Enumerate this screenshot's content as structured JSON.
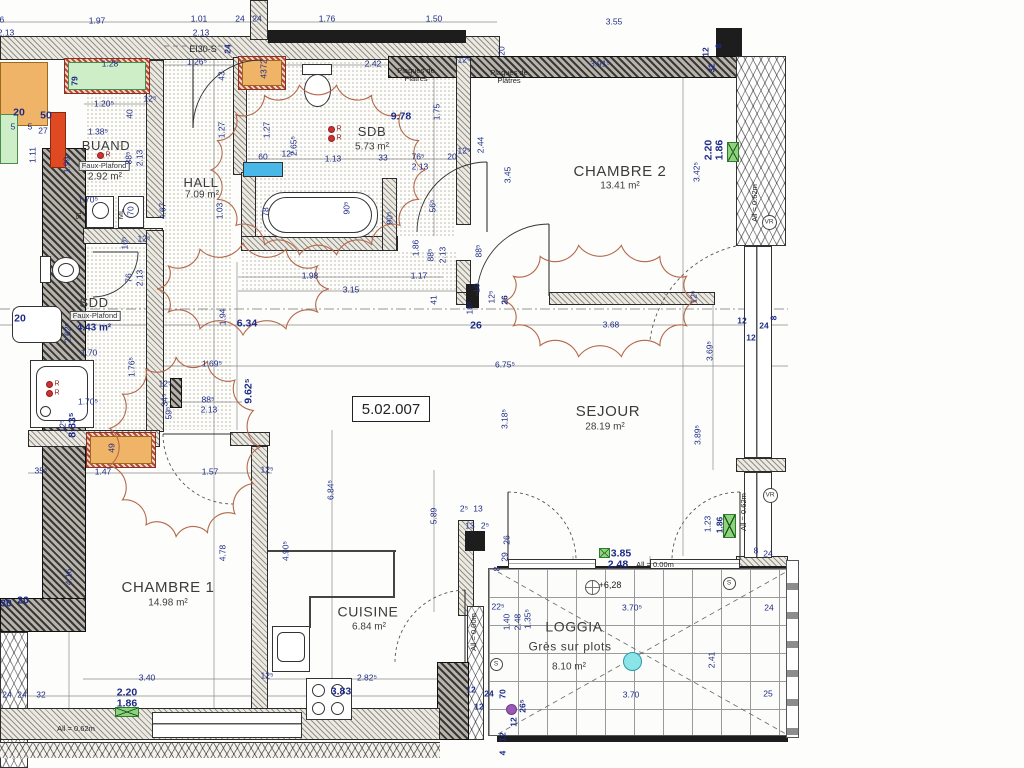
{
  "ref": "5.02.007",
  "r_label": "R",
  "colors": {
    "dim_blue": "#1d2b86",
    "cloud": "#b4684a",
    "wall_dark": "#1d1d1d",
    "green_marker": "#8fd27e",
    "cyan_fixture": "#49b8e8",
    "orange_fill": "#f0b469",
    "red_fill": "#e04a22",
    "purple_dot": "#9b59b6",
    "cyan_dot": "#8ae4e8"
  },
  "rooms": [
    {
      "name": "BUAND",
      "ns": 13,
      "x": 106,
      "y": 146,
      "note": "Faux-Plafond",
      "boxed": true,
      "nx": 104,
      "ny": 166,
      "area": "2.92 m²",
      "afs": 10,
      "ax": 105,
      "ay": 178
    },
    {
      "name": "HALL",
      "ns": 13,
      "x": 201,
      "y": 183,
      "area": "7.09 m²",
      "afs": 10,
      "ax": 202,
      "ay": 196
    },
    {
      "name": "SDB",
      "ns": 13,
      "x": 372,
      "y": 132,
      "area": "5.73 m²",
      "afs": 10,
      "ax": 372,
      "ay": 148
    },
    {
      "name": "CHAMBRE 2",
      "ns": 15,
      "x": 620,
      "y": 172,
      "area": "13.41 m²",
      "afs": 10,
      "ax": 620,
      "ay": 187
    },
    {
      "name": "SDD",
      "ns": 13,
      "x": 94,
      "y": 303,
      "note": "Faux-Plafond",
      "boxed": true,
      "nx": 95,
      "ny": 316,
      "area": "4.43 m²",
      "afs": 10,
      "ax": 94,
      "ay": 329,
      "area_blue": true
    },
    {
      "name": "SEJOUR",
      "ns": 15,
      "x": 608,
      "y": 412,
      "area": "28.19 m²",
      "afs": 10,
      "ax": 605,
      "ay": 428
    },
    {
      "name": "CHAMBRE 1",
      "ns": 15,
      "x": 168,
      "y": 588,
      "area": "14.98 m²",
      "afs": 10,
      "ax": 168,
      "ay": 604
    },
    {
      "name": "CUISINE",
      "ns": 14,
      "x": 368,
      "y": 612,
      "area": "6.84 m²",
      "afs": 10,
      "ax": 369,
      "ay": 628
    },
    {
      "name": "LOGGIA",
      "ns": 14,
      "x": 574,
      "y": 627,
      "note": "Grès sur plots",
      "boxed": false,
      "nfs": 12,
      "nx": 570,
      "ny": 647,
      "area": "8.10 m²",
      "afs": 10,
      "ax": 569,
      "ay": 668
    }
  ],
  "labels": [
    {
      "t": "1.76",
      "x": -4,
      "y": 20,
      "r": 0,
      "c": "d"
    },
    {
      "t": "2.13",
      "x": 6,
      "y": 33,
      "r": 0,
      "c": "d"
    },
    {
      "t": "1.97",
      "x": 97,
      "y": 21,
      "r": 0,
      "c": "d"
    },
    {
      "t": "1.01",
      "x": 199,
      "y": 19,
      "r": 0,
      "c": "d"
    },
    {
      "t": "2.13",
      "x": 201,
      "y": 33,
      "r": 0,
      "c": "d"
    },
    {
      "t": "24",
      "x": 240,
      "y": 19,
      "r": 0,
      "c": "d"
    },
    {
      "t": "24",
      "x": 257,
      "y": 19,
      "r": 0,
      "c": "d"
    },
    {
      "t": "1.76",
      "x": 327,
      "y": 19,
      "r": 0,
      "c": "d"
    },
    {
      "t": "1.50",
      "x": 434,
      "y": 19,
      "r": 0,
      "c": "d"
    },
    {
      "t": "3.55",
      "x": 614,
      "y": 22,
      "r": 0,
      "c": "d"
    },
    {
      "t": "EI30-S",
      "x": 203,
      "y": 50,
      "r": 0,
      "c": "k2"
    },
    {
      "t": "24",
      "x": 228,
      "y": 49,
      "r": 1,
      "c": "b2"
    },
    {
      "t": "20",
      "x": 502,
      "y": 51,
      "r": 1,
      "c": "d"
    },
    {
      "t": "1.26⁵",
      "x": 197,
      "y": 62,
      "r": 0,
      "c": "d"
    },
    {
      "t": "43",
      "x": 222,
      "y": 76,
      "r": 1,
      "c": "d"
    },
    {
      "t": "1.28",
      "x": 110,
      "y": 64,
      "r": 0,
      "c": "d"
    },
    {
      "t": "79",
      "x": 75,
      "y": 81,
      "r": 1,
      "c": "b2"
    },
    {
      "t": "72",
      "x": 264,
      "y": 64,
      "r": 1,
      "c": "d"
    },
    {
      "t": "43",
      "x": 264,
      "y": 74,
      "r": 1,
      "c": "d"
    },
    {
      "t": "2.42",
      "x": 373,
      "y": 64,
      "r": 0,
      "c": "d"
    },
    {
      "t": "Plaques de\nPlâtres",
      "x": 416,
      "y": 75,
      "r": 0,
      "c": "k"
    },
    {
      "t": "Plaques de\nPlâtres",
      "x": 509,
      "y": 77,
      "r": 0,
      "c": "k"
    },
    {
      "t": "12⁵",
      "x": 464,
      "y": 60,
      "r": 0,
      "c": "d"
    },
    {
      "t": "3.91⁵",
      "x": 600,
      "y": 64,
      "r": 0,
      "c": "d"
    },
    {
      "t": "12",
      "x": 706,
      "y": 52,
      "r": 1,
      "c": "b2"
    },
    {
      "t": "8",
      "x": 719,
      "y": 46,
      "r": 1,
      "c": "b2"
    },
    {
      "t": "32",
      "x": 712,
      "y": 68,
      "r": 1,
      "c": "b2"
    },
    {
      "t": "1.20⁵",
      "x": 104,
      "y": 104,
      "r": 0,
      "c": "d"
    },
    {
      "t": "12⁵",
      "x": 150,
      "y": 99,
      "r": 0,
      "c": "d"
    },
    {
      "t": "40",
      "x": 130,
      "y": 114,
      "r": 1,
      "c": "d"
    },
    {
      "t": "1.38⁵",
      "x": 98,
      "y": 132,
      "r": 0,
      "c": "d"
    },
    {
      "t": "20",
      "x": 19,
      "y": 113,
      "r": 0,
      "c": "b"
    },
    {
      "t": "50",
      "x": 46,
      "y": 116,
      "r": 0,
      "c": "b"
    },
    {
      "t": "5",
      "x": 13,
      "y": 127,
      "r": 0,
      "c": "d"
    },
    {
      "t": "5",
      "x": 30,
      "y": 127,
      "r": 0,
      "c": "d"
    },
    {
      "t": "27",
      "x": 43,
      "y": 131,
      "r": 0,
      "c": "d"
    },
    {
      "t": "1.11",
      "x": 33,
      "y": 155,
      "r": 1,
      "c": "d"
    },
    {
      "t": "1.99",
      "x": 67,
      "y": 165,
      "r": 1,
      "c": "d"
    },
    {
      "t": "88⁵",
      "x": 129,
      "y": 158,
      "r": 1,
      "c": "d"
    },
    {
      "t": "2.13",
      "x": 140,
      "y": 158,
      "r": 1,
      "c": "d"
    },
    {
      "t": "9.78",
      "x": 401,
      "y": 117,
      "r": 0,
      "c": "b"
    },
    {
      "t": "1.75",
      "x": 437,
      "y": 112,
      "r": 1,
      "c": "d"
    },
    {
      "t": "2.65⁵",
      "x": 294,
      "y": 146,
      "r": 1,
      "c": "d"
    },
    {
      "t": "1.27",
      "x": 222,
      "y": 130,
      "r": 1,
      "c": "d"
    },
    {
      "t": "1.27",
      "x": 267,
      "y": 130,
      "r": 1,
      "c": "d"
    },
    {
      "t": "60",
      "x": 263,
      "y": 157,
      "r": 0,
      "c": "d"
    },
    {
      "t": "12⁵",
      "x": 288,
      "y": 154,
      "r": 0,
      "c": "d"
    },
    {
      "t": "1.13",
      "x": 333,
      "y": 159,
      "r": 0,
      "c": "d"
    },
    {
      "t": "33",
      "x": 383,
      "y": 158,
      "r": 0,
      "c": "d"
    },
    {
      "t": "76⁵",
      "x": 418,
      "y": 157,
      "r": 0,
      "c": "d"
    },
    {
      "t": "2.13",
      "x": 420,
      "y": 167,
      "r": 0,
      "c": "d"
    },
    {
      "t": "20",
      "x": 452,
      "y": 157,
      "r": 0,
      "c": "d"
    },
    {
      "t": "12⁵",
      "x": 464,
      "y": 151,
      "r": 0,
      "c": "d"
    },
    {
      "t": "2.44",
      "x": 481,
      "y": 145,
      "r": 1,
      "c": "d"
    },
    {
      "t": "3.45",
      "x": 508,
      "y": 175,
      "r": 1,
      "c": "d"
    },
    {
      "t": "78",
      "x": 266,
      "y": 212,
      "r": 1,
      "c": "d"
    },
    {
      "t": "90⁵",
      "x": 347,
      "y": 208,
      "r": 1,
      "c": "d"
    },
    {
      "t": "90⁵",
      "x": 390,
      "y": 218,
      "r": 1,
      "c": "d"
    },
    {
      "t": "56⁵",
      "x": 433,
      "y": 206,
      "r": 1,
      "c": "d"
    },
    {
      "t": "1.70⁵",
      "x": 88,
      "y": 200,
      "r": 0,
      "c": "d"
    },
    {
      "t": "SL",
      "x": 79,
      "y": 215,
      "r": 1,
      "c": "k"
    },
    {
      "t": "ML",
      "x": 121,
      "y": 214,
      "r": 1,
      "c": "k"
    },
    {
      "t": "70",
      "x": 131,
      "y": 211,
      "r": 1,
      "c": "d"
    },
    {
      "t": "4.67",
      "x": 163,
      "y": 211,
      "r": 1,
      "c": "d"
    },
    {
      "t": "1.03",
      "x": 220,
      "y": 211,
      "r": 1,
      "c": "d"
    },
    {
      "t": "3.42⁵",
      "x": 697,
      "y": 172,
      "r": 1,
      "c": "d"
    },
    {
      "t": "2.20",
      "x": 709,
      "y": 150,
      "r": 1,
      "c": "b"
    },
    {
      "t": "1.86",
      "x": 720,
      "y": 150,
      "r": 1,
      "c": "b"
    },
    {
      "t": "All = 0.62m",
      "x": 755,
      "y": 203,
      "r": 1,
      "c": "k"
    },
    {
      "t": "12⁵",
      "x": 144,
      "y": 239,
      "r": 0,
      "c": "d"
    },
    {
      "t": "10⁵",
      "x": 125,
      "y": 243,
      "r": 1,
      "c": "d"
    },
    {
      "t": "76",
      "x": 129,
      "y": 278,
      "r": 1,
      "c": "d"
    },
    {
      "t": "2.13",
      "x": 140,
      "y": 278,
      "r": 1,
      "c": "d"
    },
    {
      "t": "88⁵",
      "x": 431,
      "y": 255,
      "r": 1,
      "c": "d"
    },
    {
      "t": "2.13",
      "x": 443,
      "y": 255,
      "r": 1,
      "c": "d"
    },
    {
      "t": "1.86",
      "x": 416,
      "y": 248,
      "r": 1,
      "c": "d"
    },
    {
      "t": "1.98",
      "x": 310,
      "y": 276,
      "r": 0,
      "c": "d"
    },
    {
      "t": "1.17",
      "x": 419,
      "y": 276,
      "r": 0,
      "c": "d"
    },
    {
      "t": "3.15",
      "x": 351,
      "y": 290,
      "r": 0,
      "c": "d"
    },
    {
      "t": "41",
      "x": 434,
      "y": 300,
      "r": 1,
      "c": "d"
    },
    {
      "t": "88⁵",
      "x": 479,
      "y": 251,
      "r": 1,
      "c": "d"
    },
    {
      "t": "10",
      "x": 477,
      "y": 288,
      "r": 1,
      "c": "d"
    },
    {
      "t": "18⁵",
      "x": 470,
      "y": 308,
      "r": 1,
      "c": "d"
    },
    {
      "t": "12⁵",
      "x": 492,
      "y": 297,
      "r": 1,
      "c": "d"
    },
    {
      "t": "26",
      "x": 505,
      "y": 300,
      "r": 1,
      "c": "b2"
    },
    {
      "t": "26",
      "x": 476,
      "y": 326,
      "r": 0,
      "c": "b"
    },
    {
      "t": "6.34",
      "x": 247,
      "y": 324,
      "r": 0,
      "c": "b"
    },
    {
      "t": "1.94",
      "x": 223,
      "y": 317,
      "r": 1,
      "c": "d"
    },
    {
      "t": "3.68",
      "x": 611,
      "y": 325,
      "r": 0,
      "c": "d"
    },
    {
      "t": "12⁵",
      "x": 694,
      "y": 297,
      "r": 1,
      "c": "d"
    },
    {
      "t": "12",
      "x": 742,
      "y": 321,
      "r": 0,
      "c": "b2"
    },
    {
      "t": "24",
      "x": 764,
      "y": 326,
      "r": 0,
      "c": "b2"
    },
    {
      "t": "8",
      "x": 774,
      "y": 318,
      "r": 1,
      "c": "b2"
    },
    {
      "t": "12",
      "x": 751,
      "y": 338,
      "r": 0,
      "c": "b2"
    },
    {
      "t": "3.69⁵",
      "x": 710,
      "y": 351,
      "r": 1,
      "c": "d"
    },
    {
      "t": "6.75⁵",
      "x": 505,
      "y": 365,
      "r": 0,
      "c": "d"
    },
    {
      "t": "3.18⁵",
      "x": 505,
      "y": 419,
      "r": 1,
      "c": "d"
    },
    {
      "t": "3.89⁵",
      "x": 698,
      "y": 435,
      "r": 1,
      "c": "d"
    },
    {
      "t": "1.69⁵",
      "x": 212,
      "y": 364,
      "r": 0,
      "c": "d"
    },
    {
      "t": "12⁵",
      "x": 165,
      "y": 384,
      "r": 0,
      "c": "d"
    },
    {
      "t": "34⁵",
      "x": 165,
      "y": 400,
      "r": 1,
      "c": "d"
    },
    {
      "t": "59⁵",
      "x": 169,
      "y": 413,
      "r": 1,
      "c": "d"
    },
    {
      "t": "88⁵",
      "x": 208,
      "y": 400,
      "r": 0,
      "c": "d"
    },
    {
      "t": "2.13",
      "x": 209,
      "y": 410,
      "r": 0,
      "c": "d"
    },
    {
      "t": "9.62⁵",
      "x": 249,
      "y": 391,
      "r": 1,
      "c": "b"
    },
    {
      "t": "1.70",
      "x": 89,
      "y": 353,
      "r": 0,
      "c": "d"
    },
    {
      "t": "2.62⁵",
      "x": 68,
      "y": 333,
      "r": 1,
      "c": "d"
    },
    {
      "t": "1.76⁵",
      "x": 132,
      "y": 367,
      "r": 1,
      "c": "d"
    },
    {
      "t": "20",
      "x": 20,
      "y": 319,
      "r": 0,
      "c": "b"
    },
    {
      "t": "1.70⁵",
      "x": 88,
      "y": 402,
      "r": 0,
      "c": "d"
    },
    {
      "t": "8.83⁵",
      "x": 73,
      "y": 425,
      "r": 1,
      "c": "b"
    },
    {
      "t": "12⁵",
      "x": 63,
      "y": 426,
      "r": 1,
      "c": "d"
    },
    {
      "t": "49",
      "x": 112,
      "y": 448,
      "r": 1,
      "c": "d"
    },
    {
      "t": "35⁵",
      "x": 41,
      "y": 471,
      "r": 0,
      "c": "d"
    },
    {
      "t": "1.47",
      "x": 103,
      "y": 472,
      "r": 0,
      "c": "d"
    },
    {
      "t": "1.57",
      "x": 210,
      "y": 472,
      "r": 0,
      "c": "d"
    },
    {
      "t": "12⁵",
      "x": 267,
      "y": 470,
      "r": 0,
      "c": "d"
    },
    {
      "t": "30",
      "x": 6,
      "y": 604,
      "r": 0,
      "c": "b"
    },
    {
      "t": "20",
      "x": 23,
      "y": 601,
      "r": 0,
      "c": "b"
    },
    {
      "t": "4.16",
      "x": 69,
      "y": 577,
      "r": 1,
      "c": "d"
    },
    {
      "t": "4.78",
      "x": 223,
      "y": 553,
      "r": 1,
      "c": "d"
    },
    {
      "t": "24",
      "x": 7,
      "y": 695,
      "r": 0,
      "c": "d"
    },
    {
      "t": "24",
      "x": 22,
      "y": 695,
      "r": 0,
      "c": "d"
    },
    {
      "t": "32",
      "x": 41,
      "y": 695,
      "r": 0,
      "c": "d"
    },
    {
      "t": "3.40",
      "x": 147,
      "y": 678,
      "r": 0,
      "c": "d"
    },
    {
      "t": "2.20",
      "x": 127,
      "y": 693,
      "r": 0,
      "c": "b"
    },
    {
      "t": "1.86",
      "x": 127,
      "y": 704,
      "r": 0,
      "c": "b"
    },
    {
      "t": "All = 0.62m",
      "x": 76,
      "y": 729,
      "r": 0,
      "c": "k"
    },
    {
      "t": "12⁵",
      "x": 267,
      "y": 676,
      "r": 0,
      "c": "d"
    },
    {
      "t": "6.84⁵",
      "x": 331,
      "y": 490,
      "r": 1,
      "c": "d"
    },
    {
      "t": "4.90⁵",
      "x": 286,
      "y": 551,
      "r": 1,
      "c": "d"
    },
    {
      "t": "5.89",
      "x": 434,
      "y": 516,
      "r": 1,
      "c": "d"
    },
    {
      "t": "2⁵",
      "x": 464,
      "y": 509,
      "r": 0,
      "c": "d"
    },
    {
      "t": "13",
      "x": 478,
      "y": 509,
      "r": 0,
      "c": "d"
    },
    {
      "t": "13",
      "x": 470,
      "y": 526,
      "r": 0,
      "c": "d"
    },
    {
      "t": "2⁵",
      "x": 485,
      "y": 526,
      "r": 0,
      "c": "d"
    },
    {
      "t": "26",
      "x": 507,
      "y": 540,
      "r": 1,
      "c": "d"
    },
    {
      "t": "29",
      "x": 505,
      "y": 557,
      "r": 1,
      "c": "d"
    },
    {
      "t": "8",
      "x": 497,
      "y": 569,
      "r": 1,
      "c": "d"
    },
    {
      "t": "3.85",
      "x": 621,
      "y": 554,
      "r": 0,
      "c": "b"
    },
    {
      "t": "2.48",
      "x": 618,
      "y": 565,
      "r": 0,
      "c": "b"
    },
    {
      "t": "All = 0.00m",
      "x": 655,
      "y": 565,
      "r": 0,
      "c": "k"
    },
    {
      "t": "1.23",
      "x": 708,
      "y": 524,
      "r": 1,
      "c": "d"
    },
    {
      "t": "1.86",
      "x": 720,
      "y": 525,
      "r": 1,
      "c": "b2"
    },
    {
      "t": "All = 0.62m",
      "x": 744,
      "y": 512,
      "r": 1,
      "c": "k"
    },
    {
      "t": "8",
      "x": 756,
      "y": 551,
      "r": 0,
      "c": "d"
    },
    {
      "t": "24",
      "x": 768,
      "y": 554,
      "r": 0,
      "c": "d"
    },
    {
      "t": "+6,28",
      "x": 610,
      "y": 586,
      "r": 0,
      "c": "k2"
    },
    {
      "t": "3.70⁵",
      "x": 632,
      "y": 608,
      "r": 0,
      "c": "d"
    },
    {
      "t": "24",
      "x": 769,
      "y": 608,
      "r": 0,
      "c": "d"
    },
    {
      "t": "2.41",
      "x": 712,
      "y": 660,
      "r": 1,
      "c": "d"
    },
    {
      "t": "3.70",
      "x": 631,
      "y": 695,
      "r": 0,
      "c": "d"
    },
    {
      "t": "25",
      "x": 768,
      "y": 694,
      "r": 0,
      "c": "d"
    },
    {
      "t": "22⁵",
      "x": 498,
      "y": 607,
      "r": 0,
      "c": "d"
    },
    {
      "t": "1.40",
      "x": 507,
      "y": 622,
      "r": 1,
      "c": "d"
    },
    {
      "t": "2.48",
      "x": 518,
      "y": 622,
      "r": 1,
      "c": "d"
    },
    {
      "t": "1.35⁵",
      "x": 528,
      "y": 619,
      "r": 1,
      "c": "d"
    },
    {
      "t": "All = 0.00m",
      "x": 474,
      "y": 632,
      "r": 1,
      "c": "k"
    },
    {
      "t": "2.82⁵",
      "x": 367,
      "y": 678,
      "r": 0,
      "c": "d"
    },
    {
      "t": "3.83",
      "x": 341,
      "y": 692,
      "r": 0,
      "c": "b"
    },
    {
      "t": "12",
      "x": 471,
      "y": 690,
      "r": 0,
      "c": "b2"
    },
    {
      "t": "24",
      "x": 489,
      "y": 694,
      "r": 0,
      "c": "b2"
    },
    {
      "t": "12",
      "x": 479,
      "y": 707,
      "r": 0,
      "c": "b2"
    },
    {
      "t": "70",
      "x": 503,
      "y": 694,
      "r": 1,
      "c": "b2"
    },
    {
      "t": "26⁵",
      "x": 523,
      "y": 706,
      "r": 1,
      "c": "b2"
    },
    {
      "t": "12",
      "x": 514,
      "y": 722,
      "r": 1,
      "c": "b2"
    },
    {
      "t": "12",
      "x": 503,
      "y": 737,
      "r": 1,
      "c": "b2"
    },
    {
      "t": "4",
      "x": 503,
      "y": 753,
      "r": 1,
      "c": "b2"
    }
  ],
  "markers": {
    "vr_label": "VR",
    "s_label": "S",
    "vr": [
      [
        769,
        222
      ],
      [
        770,
        495
      ]
    ],
    "s": [
      [
        496,
        664
      ],
      [
        729,
        583
      ]
    ],
    "green": [
      [
        727,
        142,
        12,
        20
      ],
      [
        599,
        548,
        11,
        10
      ],
      [
        723,
        514,
        13,
        24
      ],
      [
        115,
        707,
        24,
        10
      ]
    ],
    "red_dots": [
      [
        100,
        155
      ],
      [
        331,
        129
      ],
      [
        331,
        138
      ],
      [
        49,
        384
      ],
      [
        49,
        393
      ]
    ],
    "purple_dot": [
      511,
      709
    ],
    "cyan_dot": [
      632,
      661
    ],
    "level_symbol": [
      592,
      587
    ]
  }
}
